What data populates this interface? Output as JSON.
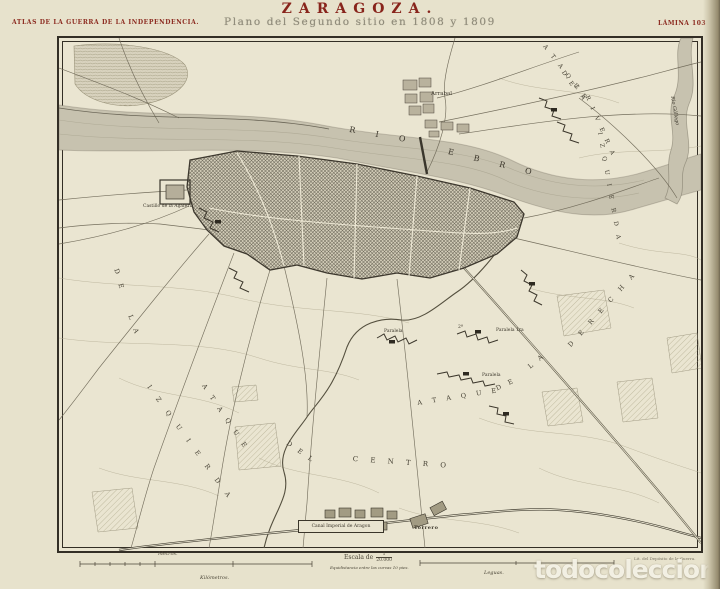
{
  "header": {
    "series": "ATLAS DE LA GUERRA DE LA INDEPENDENCIA.",
    "title": "ZARAGOZA.",
    "subtitle": "Plano del Segundo sitio en 1808 y 1809",
    "plate": "LÁMINA 103"
  },
  "map": {
    "rio": "R I O",
    "ebro": "E B R O",
    "gallego": "Rio Gállego",
    "arrabal": "Arrabal",
    "castillo": "Castillo de la Aljafería",
    "attack_left": {
      "p1": "A T A Q U E",
      "p2": "D E",
      "p3": "L A",
      "p4": "I Z Q U I E R D A"
    },
    "attack_riverbank": {
      "p1": "A T A Q U E",
      "p2": "D E",
      "p3": "L A",
      "p4": "R I V E R A",
      "p5": "I Z Q U I E R D A"
    },
    "attack_center": {
      "p1": "A T A Q U E",
      "p2": "D E L",
      "p3": "C E N T R O"
    },
    "attack_right": {
      "p1": "A T A Q U E",
      "p2": "D E",
      "p3": "L A",
      "p4": "D E R E C H A"
    },
    "paralela_west": "Paralela",
    "paralela_2a": "2ª",
    "paralela_first": "Paralela 1ra",
    "paralela_south": "Paralela",
    "canal": "Canal Imperial de Aragon",
    "torrero": "Torrero"
  },
  "scalebar": {
    "metros": "Metros.",
    "kilometros": "Kilómetros.",
    "escala": "Escala de",
    "escala_num": "1",
    "escala_den": "20.000",
    "equidistancia": "Equidistancia entre las curvas 10 pies.",
    "leguas": "Leguas.",
    "credit": "Lit. del Depósito de la Guerra."
  },
  "watermark": "todocoleccion",
  "colors": {
    "accent_red": "#88241b",
    "paper": "#e7e2cc",
    "ink": "#3a362c",
    "water": "#c7c2af"
  }
}
